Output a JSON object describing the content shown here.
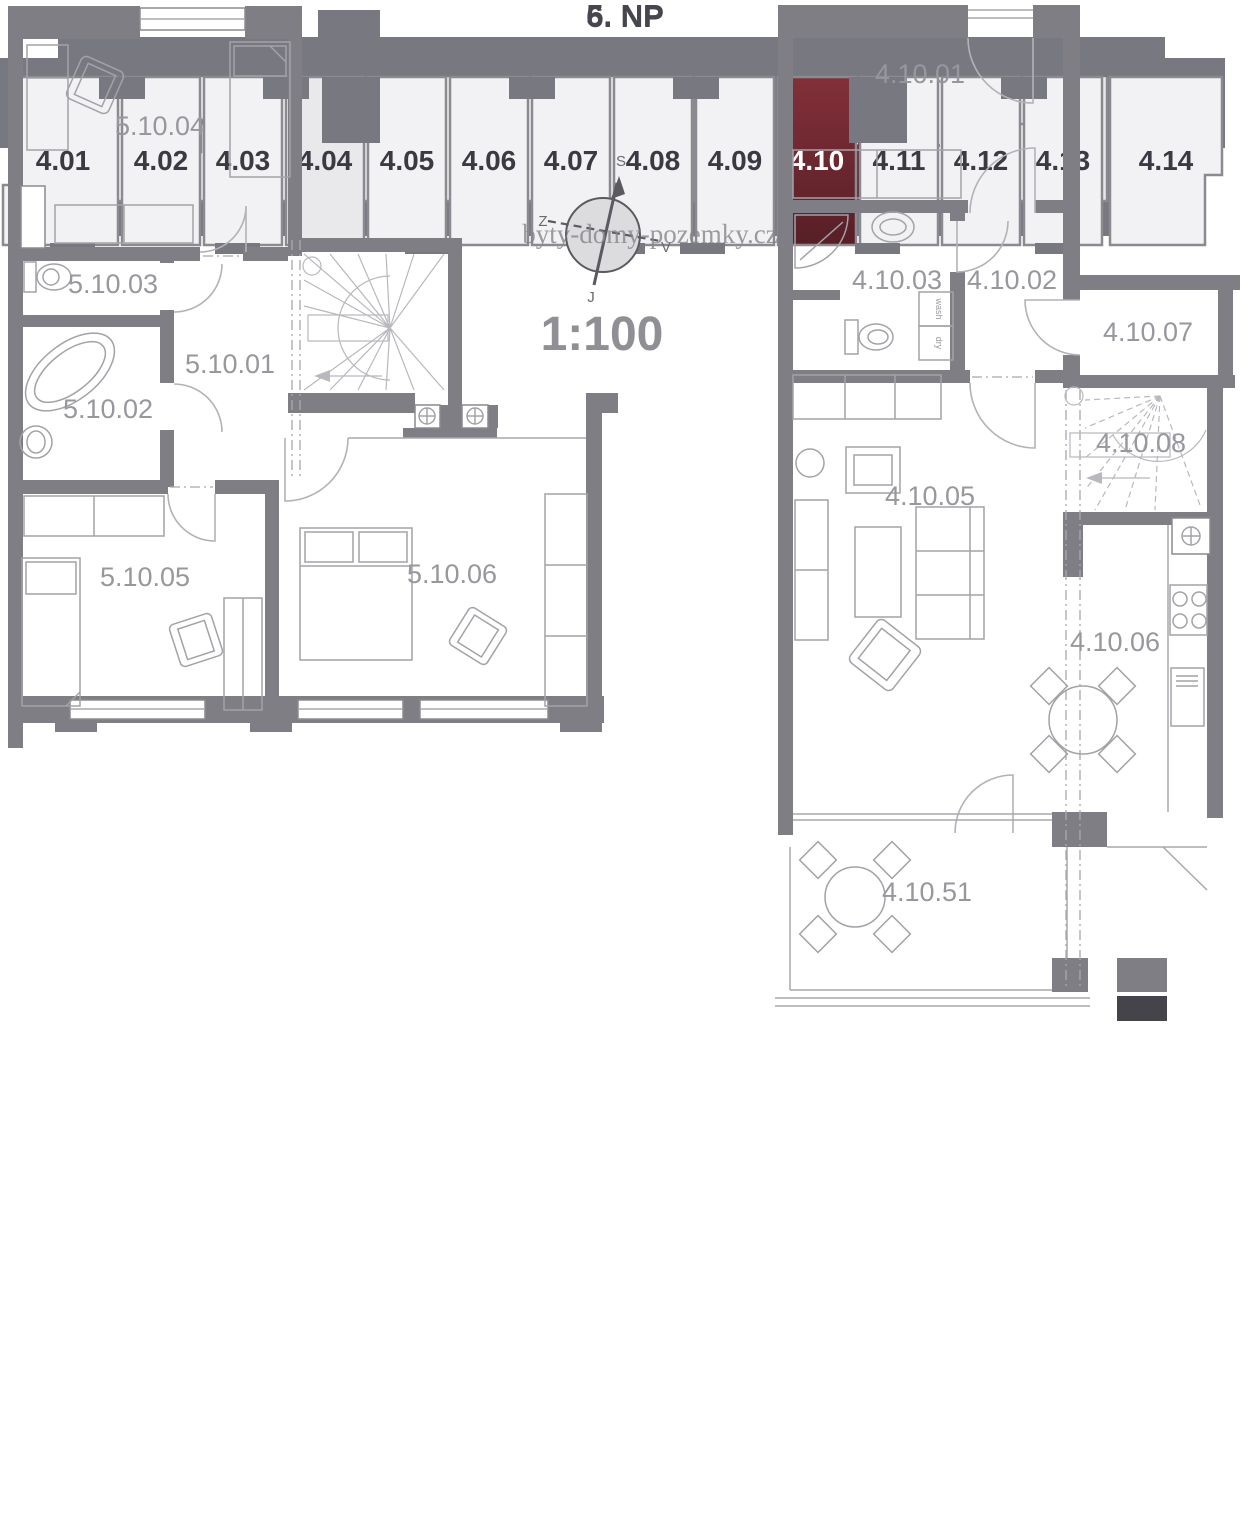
{
  "np6": {
    "title": "6. NP",
    "units": [
      "4.02",
      "4.03",
      "4.04",
      "4.05",
      "4.06",
      "4.07",
      "4.08",
      "4.09",
      "4.10",
      "4.11",
      "4.12",
      "4.13"
    ],
    "highlighted_unit": "4.10"
  },
  "np5": {
    "title": "5. NP",
    "units": [
      "4.01",
      "4.02",
      "4.03",
      "4.04",
      "4.05",
      "4.06",
      "4.07",
      "4.08",
      "4.09",
      "4.10",
      "4.11",
      "4.12",
      "4.13",
      "4.14"
    ],
    "highlighted_unit": "4.10"
  },
  "left_plan": {
    "rooms": [
      "5.10.04",
      "5.10.03",
      "5.10.02",
      "5.10.01",
      "5.10.05",
      "5.10.06"
    ]
  },
  "right_plan": {
    "rooms": [
      "4.10.01",
      "4.10.03",
      "4.10.02",
      "4.10.07",
      "4.10.08",
      "4.10.05",
      "4.10.06",
      "4.10.51"
    ],
    "appliances": {
      "washer": "wash",
      "dryer": "dry"
    }
  },
  "compass": {
    "north": "S",
    "south": "J",
    "west": "Z",
    "east": "V"
  },
  "scale_label": "1:100",
  "watermark": "byty-domy-pozemky.cz",
  "colors": {
    "building_gray": "#787880",
    "wall_gray": "#7e7e84",
    "unit_light": "#f2f2f4",
    "unit_alt": "#e9e9ec",
    "highlight_red_top": "#82303a",
    "highlight_red_bottom": "#571f26",
    "unit_label": "#3a3a42",
    "room_label": "#97979d"
  }
}
